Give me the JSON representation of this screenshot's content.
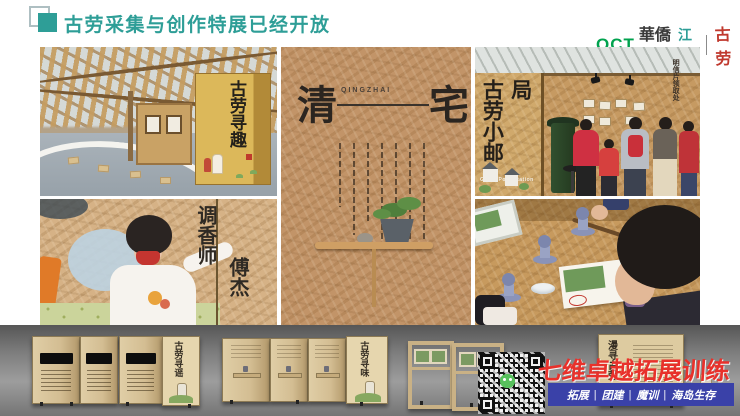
{
  "slide": {
    "header": {
      "title": "古劳采集与创作特展已经开放",
      "logo_oct": "OCT",
      "logo_brand": "華僑城",
      "logo_city": "江门",
      "logo_divider": "|",
      "logo_stamp": "古劳"
    },
    "photos": {
      "canopy": {
        "box_sign": "古劳寻趣"
      },
      "perfumer": {
        "role_label": "调香师",
        "name_label": "傅杰"
      },
      "qingzhai": {
        "char_left": "清",
        "char_right": "宅",
        "pinyin": "QINGZHAI"
      },
      "post_station": {
        "sign_cn": "古劳小邮局",
        "sign_en": "Gulao Post Station",
        "pickup_label": "明信片领取处"
      }
    },
    "bottom_strip": {
      "panel_sign_1": "古劳寻谣",
      "panel_sign_2": "古劳寻味",
      "panel_sign_3": "漫寻古劳",
      "watermark": "七维卓越拓展训练",
      "banner": {
        "items": [
          "拓展",
          "团建",
          "魔训",
          "海岛生存"
        ],
        "separator": "|"
      }
    },
    "colors": {
      "accent_teal": "#2E9E97",
      "oct_green": "#00A24E",
      "stamp_red": "#C0392E",
      "watermark_red": "#E8312B",
      "banner_blue": "#3A41A8"
    }
  }
}
